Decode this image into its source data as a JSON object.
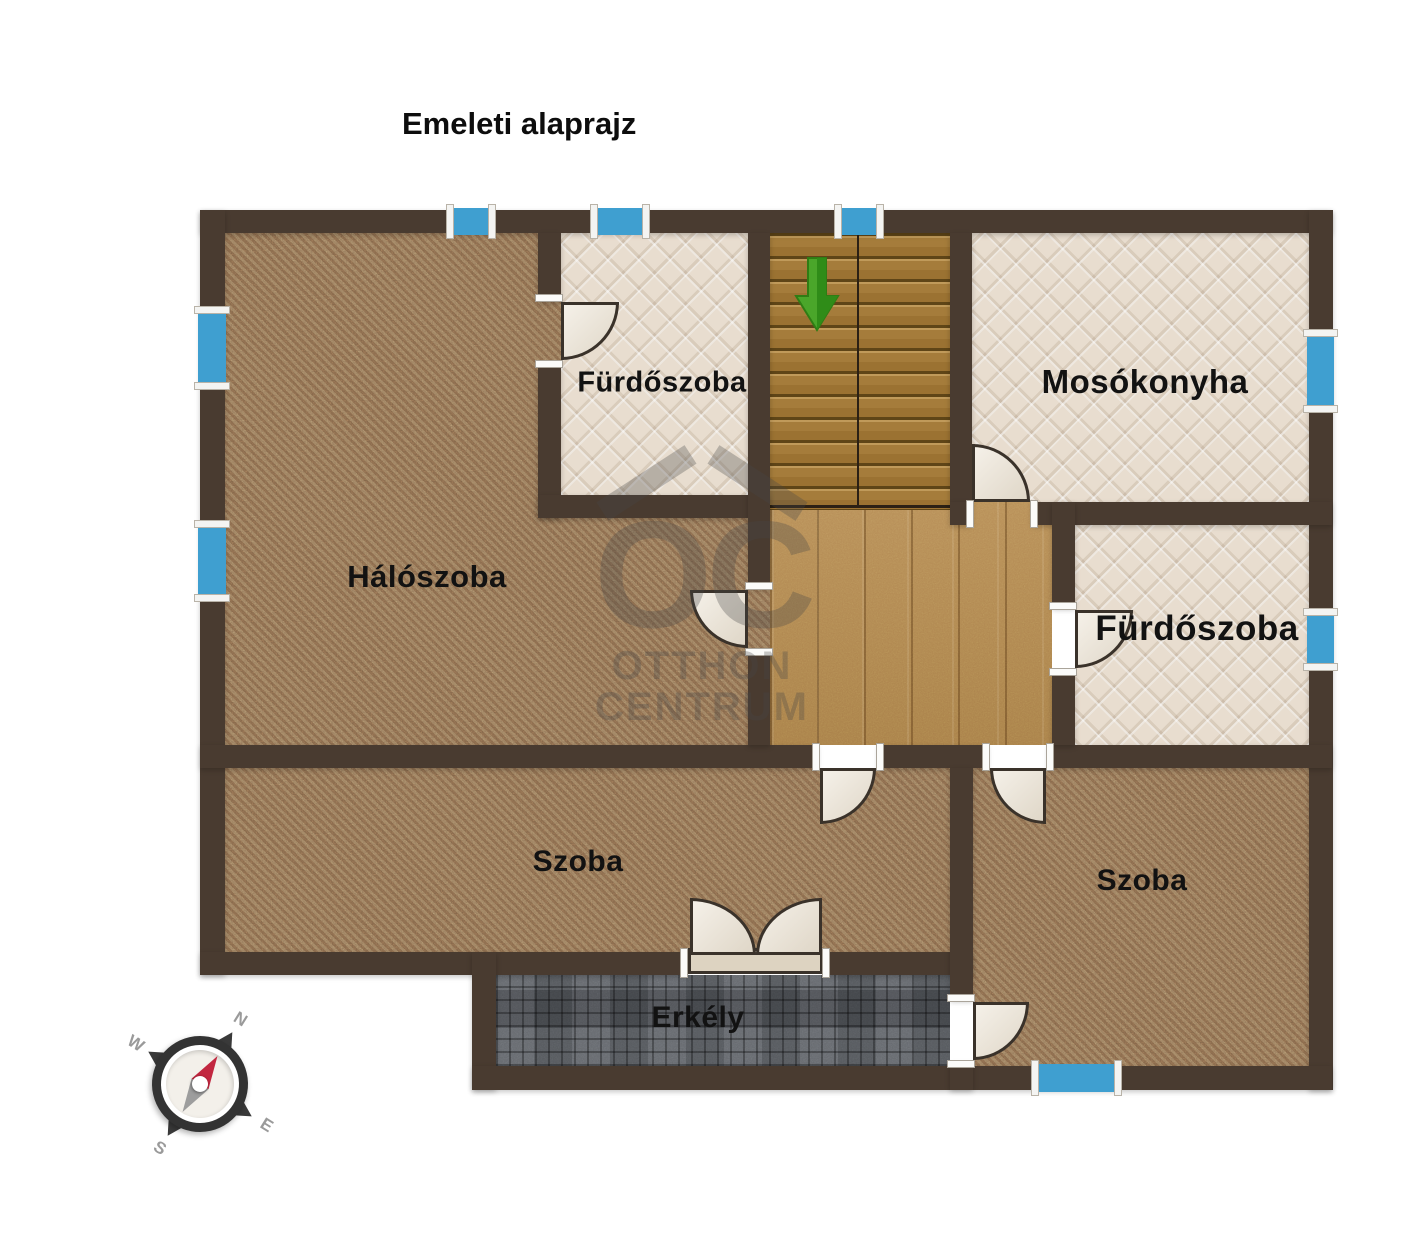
{
  "title": "Emeleti alaprajz",
  "rooms": [
    {
      "id": "furdoszoba-top",
      "label": "Fürdőszoba"
    },
    {
      "id": "mosokonyha",
      "label": "Mosókonyha"
    },
    {
      "id": "haloszoba",
      "label": "Hálószoba"
    },
    {
      "id": "furdoszoba-right",
      "label": "Fürdőszoba"
    },
    {
      "id": "szoba-left",
      "label": "Szoba"
    },
    {
      "id": "szoba-right",
      "label": "Szoba"
    },
    {
      "id": "erkely",
      "label": "Erkély"
    }
  ],
  "stairs": {
    "direction_arrow": "down"
  },
  "compass": {
    "north": "N",
    "south": "S",
    "east": "E",
    "west": "W"
  },
  "watermark": {
    "monogram": "OC",
    "line1": "OTTHON",
    "line2": "CENTRUM"
  },
  "colors": {
    "wall": "#493b30",
    "carpet": "#8a6c4f",
    "tile": "#e8ddcf",
    "stair_wood": "#a57c3b",
    "hall_wood": "#b4884e",
    "balcony_deck": "#55595e",
    "window_glass": "#3f9fd0",
    "door_leaf": "#ebe2d2",
    "arrow_green": "#4aa62a",
    "needle_red": "#c22740"
  }
}
